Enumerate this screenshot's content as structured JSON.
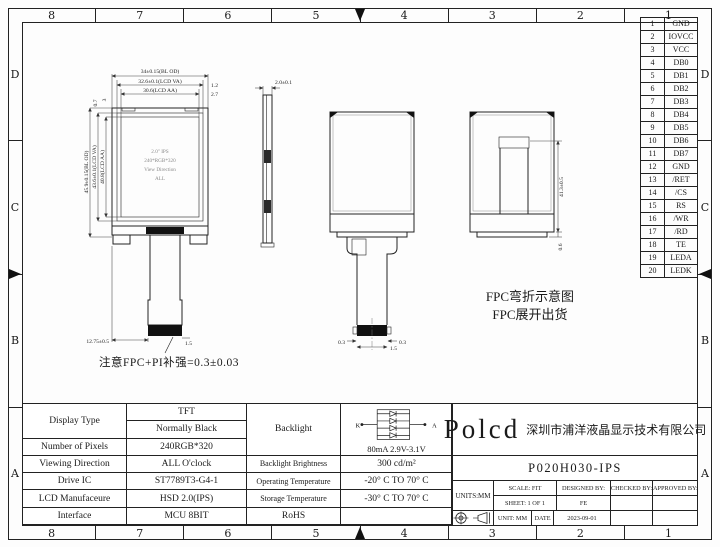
{
  "border": {
    "cols": [
      "8",
      "7",
      "6",
      "5",
      "4",
      "3",
      "2",
      "1"
    ],
    "rows": [
      "D",
      "C",
      "B",
      "A"
    ]
  },
  "pin_table": {
    "pins": [
      {
        "no": "1",
        "name": "GND"
      },
      {
        "no": "2",
        "name": "IOVCC"
      },
      {
        "no": "3",
        "name": "VCC"
      },
      {
        "no": "4",
        "name": "DB0"
      },
      {
        "no": "5",
        "name": "DB1"
      },
      {
        "no": "6",
        "name": "DB2"
      },
      {
        "no": "7",
        "name": "DB3"
      },
      {
        "no": "8",
        "name": "DB4"
      },
      {
        "no": "9",
        "name": "DB5"
      },
      {
        "no": "10",
        "name": "DB6"
      },
      {
        "no": "11",
        "name": "DB7"
      },
      {
        "no": "12",
        "name": "GND"
      },
      {
        "no": "13",
        "name": "/RET"
      },
      {
        "no": "14",
        "name": "/CS"
      },
      {
        "no": "15",
        "name": "RS"
      },
      {
        "no": "16",
        "name": "/WR"
      },
      {
        "no": "17",
        "name": "/RD"
      },
      {
        "no": "18",
        "name": "TE"
      },
      {
        "no": "19",
        "name": "LEDA"
      },
      {
        "no": "20",
        "name": "LEDK"
      }
    ]
  },
  "views": {
    "front": {
      "screen_lines": [
        "2.0\" IPS",
        "240*RGB*320",
        "View Direction",
        "ALL"
      ],
      "dim_outline_w": "34±0.15(BL OD)",
      "dim_va_w": "32.6±0.1(LCD VA)",
      "dim_aa_w": "30.6(LCD AA)",
      "dim_edge1": "1.2",
      "dim_edge2": "2.7",
      "dim_outline_h": "45.9±0.15(BL OD)",
      "dim_va_h": "43.6±0.1(LCD VA)",
      "dim_aa_h": "40.8(LCD AA)",
      "dim_top1": "0.7",
      "dim_top2": "3",
      "dim_fpc": "12.75±0.5",
      "dim_tail": "1.5"
    },
    "side": {
      "dim_thickness": "2.0±0.1"
    },
    "back": {
      "dim_pad_l": "0.3",
      "dim_pad_r": "0.3",
      "dim_pitch": "1.5"
    },
    "folded": {
      "dim_height": "41.3±0.5",
      "dim_gap": "0.6"
    }
  },
  "notes": {
    "fpc_line1": "FPC弯折示意图",
    "fpc_line2": "FPC展开出货",
    "caution": "注意FPC+PI补强=0.3±0.03"
  },
  "backlight": {
    "cathode": "K",
    "anode": "A",
    "rating": "80mA  2.9V-3.1V"
  },
  "spec_table": {
    "display_type_label": "Display Type",
    "display_type_1": "TFT",
    "display_type_2": "Normally Black",
    "pixels_label": "Number of Pixels",
    "pixels_value": "240RGB*320",
    "viewing_label": "Viewing Direction",
    "viewing_value": "ALL O'clock",
    "drive_label": "Drive IC",
    "drive_value": "ST7789T3-G4-1",
    "manufacture_label": "LCD Manufaceure",
    "manufacture_value": "HSD 2.0(IPS)",
    "interface_label": "Interface",
    "interface_value": "MCU 8BIT",
    "backlight_header": "Backlight",
    "brightness_label": "Backlight Brightness",
    "brightness_value": "300 cd/m²",
    "operating_label": "Operating Temperature",
    "operating_value": "-20° C TO 70° C",
    "storage_label": "Storage Temperature",
    "storage_value": "-30° C TO 70° C",
    "rohs_label": "RoHS"
  },
  "title_block": {
    "logo": "Polcd",
    "company": "深圳市浦洋液晶显示技术有限公司",
    "model": "P020H030-IPS",
    "units": "UNITS:MM",
    "scale": "SCALE: FIT",
    "designed_by": "DESIGNED BY:",
    "checked_by": "CHECKED BY:",
    "approved_by": "APPROVED BY:",
    "sheet": "SHEET: 1 OF 1",
    "designer": "FE",
    "unit": "UNIT: MM",
    "date_label": "DATE",
    "date": "2023-09-01"
  }
}
